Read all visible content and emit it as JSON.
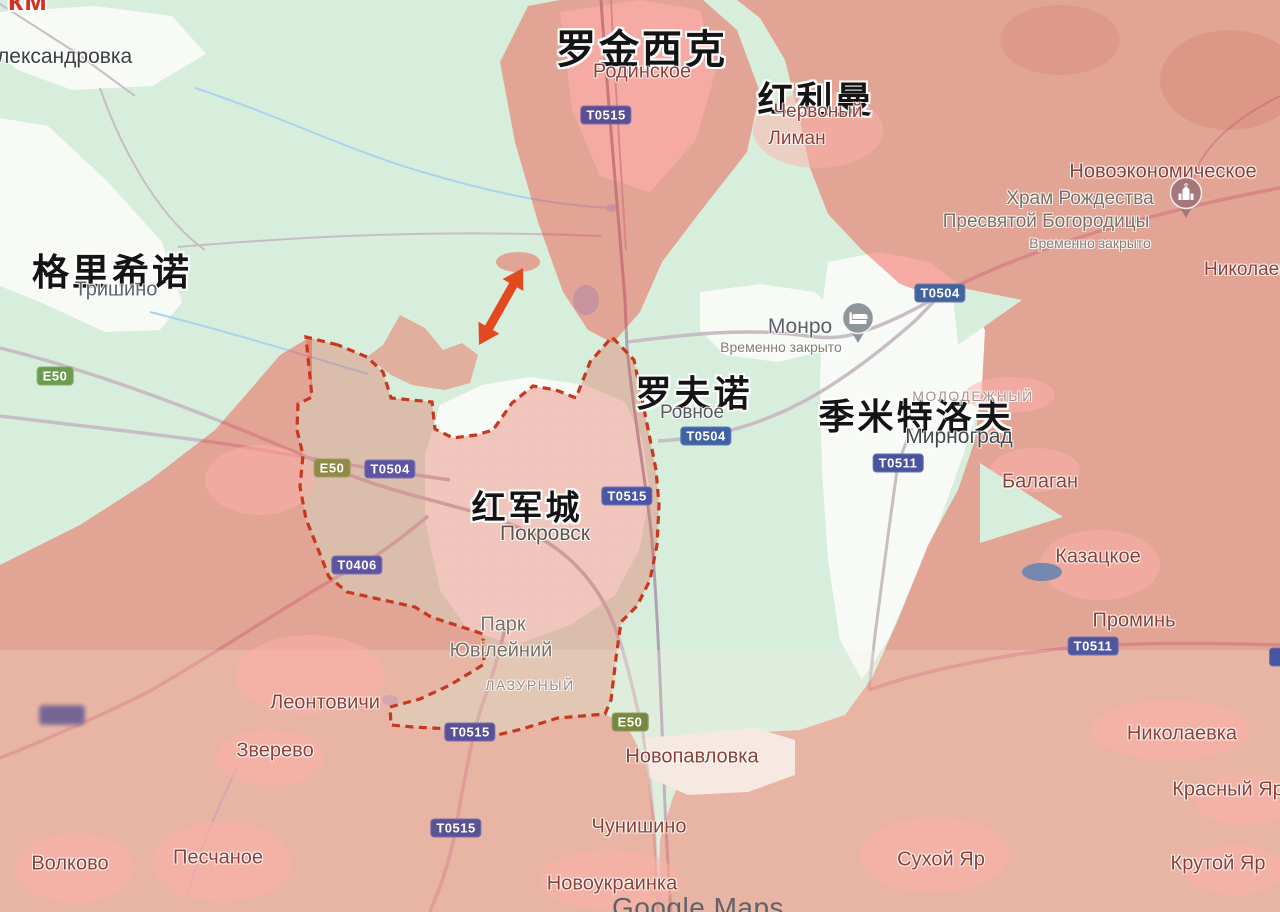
{
  "map": {
    "attribution": "Google Maps",
    "distance": {
      "label": "1.5 км",
      "x": 433,
      "y": 288
    },
    "colors": {
      "base_green": "#D7EEDC",
      "urban_white": "#F7FAF5",
      "occupied_overlay": "rgba(242,53,39,0.40)",
      "claimed_overlay": "rgba(225,75,55,0.30)",
      "village_patch": "rgba(255,175,170,0.50)",
      "front_line": "#C8371F",
      "arrow_red": "#E2491F",
      "water": "#A9D3EE",
      "road": "#C9BDC5",
      "railway": "#B0A2B2"
    },
    "chinese_labels": [
      {
        "id": "luojinxike",
        "t": "罗金西克",
        "x": 642,
        "y": 46,
        "s": 40
      },
      {
        "id": "hongliman",
        "t": "红利曼",
        "x": 816,
        "y": 97,
        "s": 36
      },
      {
        "id": "gelixinuo",
        "t": "格里希诺",
        "x": 112,
        "y": 269,
        "s": 37
      },
      {
        "id": "luofunuo",
        "t": "罗夫诺",
        "x": 694,
        "y": 391,
        "s": 36
      },
      {
        "id": "jimiteluofu",
        "t": "季米特洛夫",
        "x": 916,
        "y": 414,
        "s": 36
      },
      {
        "id": "hongjuncheng",
        "t": "红军城",
        "x": 527,
        "y": 505,
        "s": 34
      }
    ],
    "place_labels": [
      {
        "id": "aleksandrovka",
        "t": "Александровка",
        "x": -17,
        "y": 57,
        "s": 21,
        "c": "#3C4043",
        "anchor": "left"
      },
      {
        "id": "trishino",
        "t": "Тришино",
        "x": 116,
        "y": 290,
        "s": 20,
        "c": "#5F6368"
      },
      {
        "id": "rodynske",
        "t": "Родинское",
        "x": 642,
        "y": 72,
        "s": 20,
        "c": "#8E4038"
      },
      {
        "id": "chervony-liman-1",
        "t": "Червоный",
        "x": 818,
        "y": 112,
        "s": 19,
        "c": "#8E4038"
      },
      {
        "id": "chervony-liman-2",
        "t": "Лиман",
        "x": 797,
        "y": 139,
        "s": 19,
        "c": "#8E4038"
      },
      {
        "id": "novoekonomicheskoe",
        "t": "Новоэкономическое",
        "x": 1163,
        "y": 172,
        "s": 20,
        "c": "#8E4038"
      },
      {
        "id": "khram-line-1",
        "t": "Храм Рождества",
        "x": 1080,
        "y": 199,
        "s": 19,
        "c": "#7D6E66"
      },
      {
        "id": "khram-line-2",
        "t": "Пресвятой Богородицы",
        "x": 1046,
        "y": 222,
        "s": 19,
        "c": "#7D6E66"
      },
      {
        "id": "khram-status",
        "t": "Временно закрыто",
        "x": 1090,
        "y": 243,
        "s": 14,
        "c": "#8A7B72"
      },
      {
        "id": "nikolaev-clipped",
        "t": "Николаев",
        "x": 1204,
        "y": 270,
        "s": 19,
        "c": "#8E4038",
        "anchor": "left"
      },
      {
        "id": "monro",
        "t": "Монро",
        "x": 800,
        "y": 327,
        "s": 21,
        "c": "#5B6065"
      },
      {
        "id": "monro-status",
        "t": "Временно закрыто",
        "x": 781,
        "y": 347,
        "s": 14,
        "c": "#857A74"
      },
      {
        "id": "rovne",
        "t": "Ровное",
        "x": 692,
        "y": 413,
        "s": 19,
        "c": "#55595D"
      },
      {
        "id": "molodezhny",
        "t": "МОЛОДЕЖНЫЙ",
        "x": 973,
        "y": 396,
        "s": 14,
        "c": "#A39490",
        "ls": 1.5
      },
      {
        "id": "mirnograd",
        "t": "Мирноград",
        "x": 959,
        "y": 437,
        "s": 21,
        "c": "#45494D"
      },
      {
        "id": "pokrovsk",
        "t": "Покровск",
        "x": 545,
        "y": 534,
        "s": 21,
        "c": "#5F544C"
      },
      {
        "id": "park-yuvileiny-1",
        "t": "Парк",
        "x": 503,
        "y": 625,
        "s": 20,
        "c": "#7A6F64"
      },
      {
        "id": "park-yuvileiny-2",
        "t": "Ювілейний",
        "x": 501,
        "y": 651,
        "s": 20,
        "c": "#7A6F64"
      },
      {
        "id": "lazurny",
        "t": "ЛАЗУРНЫЙ",
        "x": 530,
        "y": 685,
        "s": 14,
        "c": "#9B8A84",
        "ls": 1.5
      },
      {
        "id": "leontovichi",
        "t": "Леонтовичи",
        "x": 325,
        "y": 703,
        "s": 20,
        "c": "#8E4038"
      },
      {
        "id": "zverevo",
        "t": "Зверево",
        "x": 275,
        "y": 751,
        "s": 20,
        "c": "#8E4038"
      },
      {
        "id": "volkovo",
        "t": "Волково",
        "x": 70,
        "y": 864,
        "s": 20,
        "c": "#8E4038"
      },
      {
        "id": "peschanoe",
        "t": "Песчаное",
        "x": 218,
        "y": 858,
        "s": 20,
        "c": "#8E4038"
      },
      {
        "id": "novopavlovka",
        "t": "Новопавловка",
        "x": 692,
        "y": 757,
        "s": 20,
        "c": "#8E4038"
      },
      {
        "id": "chunishino",
        "t": "Чунишино",
        "x": 639,
        "y": 827,
        "s": 20,
        "c": "#8E4038"
      },
      {
        "id": "novoukrainka",
        "t": "Новоукраинка",
        "x": 612,
        "y": 884,
        "s": 20,
        "c": "#8E4038"
      },
      {
        "id": "sukhoy-yar",
        "t": "Сухой Яр",
        "x": 941,
        "y": 860,
        "s": 20,
        "c": "#8E4038"
      },
      {
        "id": "nikolaevka",
        "t": "Николаевка",
        "x": 1182,
        "y": 734,
        "s": 20,
        "c": "#8E4038"
      },
      {
        "id": "krasny-yar",
        "t": "Красный Яр",
        "x": 1228,
        "y": 790,
        "s": 20,
        "c": "#8E4038"
      },
      {
        "id": "krutoy-yar",
        "t": "Крутой Яр",
        "x": 1218,
        "y": 864,
        "s": 20,
        "c": "#8E4038"
      },
      {
        "id": "balagan",
        "t": "Балаган",
        "x": 1040,
        "y": 482,
        "s": 20,
        "c": "#8E4038"
      },
      {
        "id": "kazatskoe",
        "t": "Казацкое",
        "x": 1098,
        "y": 557,
        "s": 20,
        "c": "#8E4038"
      },
      {
        "id": "promin",
        "t": "Проминь",
        "x": 1134,
        "y": 621,
        "s": 20,
        "c": "#8E4038"
      }
    ],
    "road_badges": [
      {
        "id": "t0515-north",
        "t": "Т0515",
        "x": 606,
        "y": 115,
        "bg": "#5A4F92"
      },
      {
        "id": "t0504-northeast",
        "t": "Т0504",
        "x": 940,
        "y": 293,
        "bg": "#44639E"
      },
      {
        "id": "t0504-rovne",
        "t": "Т0504",
        "x": 706,
        "y": 436,
        "bg": "#3F62A3"
      },
      {
        "id": "t0511-mirnograd",
        "t": "Т0511",
        "x": 898,
        "y": 463,
        "bg": "#49539E"
      },
      {
        "id": "e50-pokrovsk",
        "t": "Е50",
        "x": 332,
        "y": 468,
        "bg": "#8F8A45"
      },
      {
        "id": "t0504-pokrovsk",
        "t": "Т0504",
        "x": 390,
        "y": 469,
        "bg": "#5D55A4"
      },
      {
        "id": "t0515-pokrovsk-east",
        "t": "Т0515",
        "x": 627,
        "y": 496,
        "bg": "#4B55A6"
      },
      {
        "id": "t0406-southwest",
        "t": "Т0406",
        "x": 357,
        "y": 565,
        "bg": "#5C54A3"
      },
      {
        "id": "t0515-south",
        "t": "Т0515",
        "x": 470,
        "y": 732,
        "bg": "#5A5096"
      },
      {
        "id": "e50-southeast",
        "t": "Е50",
        "x": 630,
        "y": 722,
        "bg": "#78883F"
      },
      {
        "id": "t0515-far-south",
        "t": "Т0515",
        "x": 456,
        "y": 828,
        "bg": "#5A5293"
      },
      {
        "id": "e50-west",
        "t": "Е50",
        "x": 55,
        "y": 376,
        "bg": "#6C9B50"
      },
      {
        "id": "t0511-southeast",
        "t": "Т0511",
        "x": 1093,
        "y": 646,
        "bg": "#4E56A0"
      },
      {
        "id": "road-badge-blurred",
        "t": "",
        "x": 62,
        "y": 715,
        "bg": "#6A5D91",
        "blur": true,
        "wpx": 46,
        "hpx": 20
      },
      {
        "id": "road-badge-partial",
        "t": "",
        "x": 1276,
        "y": 657,
        "bg": "#4756A0",
        "wpx": 14,
        "hpx": 19
      }
    ],
    "pois": [
      {
        "id": "church-poi",
        "glyph": "church-icon",
        "x": 1186,
        "y": 225,
        "color": "#A5767A"
      },
      {
        "id": "lodging-poi",
        "glyph": "lodging-icon",
        "x": 858,
        "y": 350,
        "color": "#8F969B"
      }
    ]
  }
}
